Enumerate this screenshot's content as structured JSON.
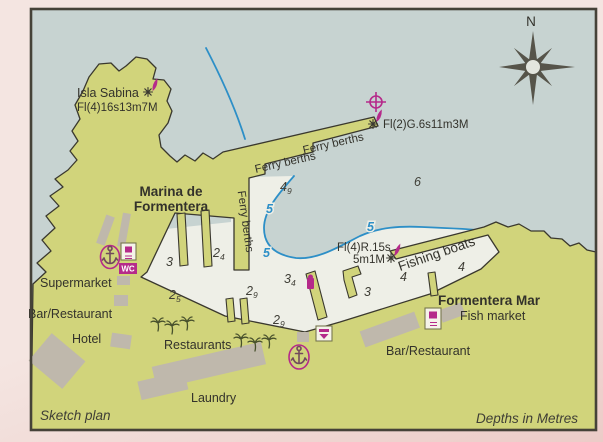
{
  "footer": {
    "sketch_plan": "Sketch plan",
    "depths_note": "Depths in Metres"
  },
  "compass": {
    "north": "N"
  },
  "lights": {
    "isla_sabina_name": "Isla Sabina",
    "isla_sabina_char": "Fl(4)16s13m7M",
    "green_pierhead_char": "Fl(2)G.6s11m3M",
    "red_breakwater_char": "Fl(4)R.15s",
    "red_breakwater_range": "5m1M"
  },
  "areas": {
    "marina_line1": "Marina de",
    "marina_line2": "Formentera",
    "formentera_mar": "Formentera Mar",
    "fishing_boats": "Fishing boats"
  },
  "berths": {
    "ferry": "Ferry berths"
  },
  "facilities": {
    "supermarket": "Supermarket",
    "bar_restaurant_west": "Bar/Restaurant",
    "hotel": "Hotel",
    "restaurants": "Restaurants",
    "laundry": "Laundry",
    "bar_restaurant_east": "Bar/Restaurant",
    "fish_market": "Fish market",
    "wc": "WC"
  },
  "depths": {
    "d6": {
      "main": "6"
    },
    "d49": {
      "main": "4",
      "sub": "9"
    },
    "d24": {
      "main": "2",
      "sub": "4"
    },
    "d25": {
      "main": "2",
      "sub": "5"
    },
    "d29a": {
      "main": "2",
      "sub": "9"
    },
    "d34": {
      "main": "3",
      "sub": "4"
    },
    "d29b": {
      "main": "2",
      "sub": "9"
    },
    "d3a": {
      "main": "3"
    },
    "d3b": {
      "main": "3"
    },
    "d4a": {
      "main": "4"
    },
    "d4b": {
      "main": "4"
    }
  },
  "contour": {
    "five": "5"
  },
  "colors": {
    "magenta": "#b52a8a",
    "land": "#d1d47b",
    "water": "#c7d3d1",
    "shallow": "#eeefe7",
    "blue": "#2d8fc7",
    "building": "#bfb8ac",
    "ink": "#33322b"
  }
}
